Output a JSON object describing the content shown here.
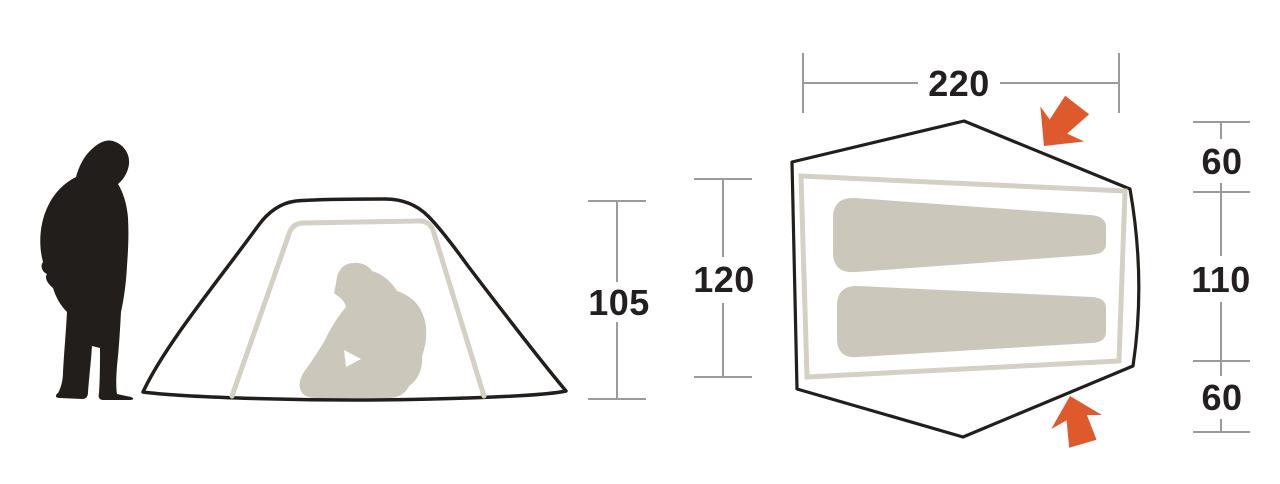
{
  "colors": {
    "outline": "#221e1b",
    "dim": "#9b9b9b",
    "beige": "#d4d1c4",
    "mat": "#cbc8bb",
    "arrow": "#de5a2d",
    "text": "#231f20",
    "background": "#ffffff"
  },
  "side_view": {
    "height_label": "105"
  },
  "top_view": {
    "length_label": "220",
    "width_label": "120",
    "right_dimension_labels": [
      "60",
      "110",
      "60"
    ]
  }
}
